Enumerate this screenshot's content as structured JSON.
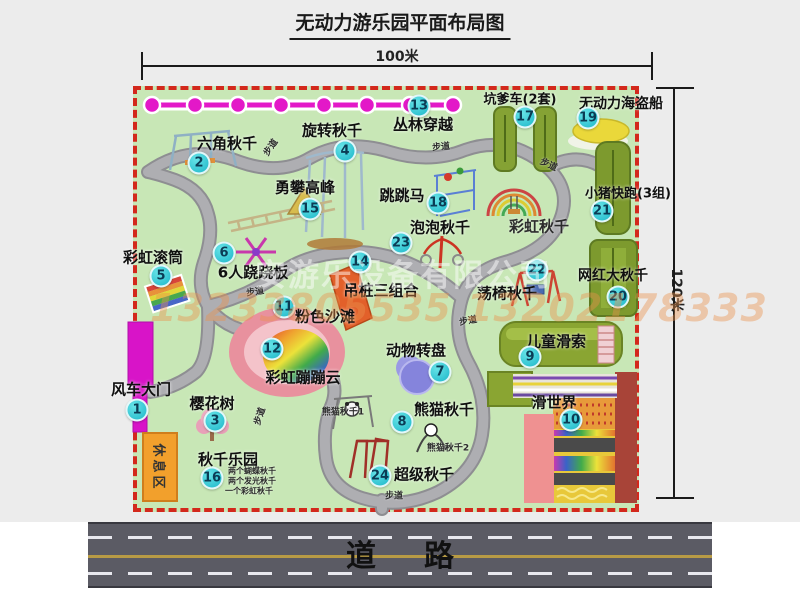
{
  "title": "无动力游乐园平面布局图",
  "dimensions": {
    "top": "100米",
    "right": "120米"
  },
  "road": {
    "label": "道路"
  },
  "watermark": {
    "company": "安游乐设备有限公司",
    "phones": "13233805535 13202178333"
  },
  "rest_area": {
    "label": "休息区"
  },
  "attractions": [
    {
      "num": "1",
      "name": "风车大门",
      "nx": 137,
      "ny": 410,
      "lx": 141,
      "ly": 389,
      "fs": 15
    },
    {
      "num": "2",
      "name": "六角秋千",
      "nx": 199,
      "ny": 163,
      "lx": 227,
      "ly": 143,
      "fs": 15
    },
    {
      "num": "3",
      "name": "樱花树",
      "nx": 215,
      "ny": 421,
      "lx": 212,
      "ly": 403,
      "fs": 15
    },
    {
      "num": "4",
      "name": "旋转秋千",
      "nx": 345,
      "ny": 151,
      "lx": 332,
      "ly": 130,
      "fs": 15
    },
    {
      "num": "5",
      "name": "彩虹滚筒",
      "nx": 161,
      "ny": 276,
      "lx": 153,
      "ly": 257,
      "fs": 15
    },
    {
      "num": "6",
      "name": "6人跷跷板",
      "nx": 224,
      "ny": 253,
      "lx": 253,
      "ly": 272,
      "fs": 15
    },
    {
      "num": "7",
      "name": "动物转盘",
      "nx": 440,
      "ny": 372,
      "lx": 416,
      "ly": 350,
      "fs": 15
    },
    {
      "num": "8",
      "name": "熊猫秋千",
      "nx": 402,
      "ny": 422,
      "lx": 444,
      "ly": 409,
      "fs": 15
    },
    {
      "num": "9",
      "name": "儿童滑索",
      "nx": 530,
      "ny": 357,
      "lx": 556,
      "ly": 341,
      "fs": 15
    },
    {
      "num": "10",
      "name": "滑世界",
      "nx": 571,
      "ny": 420,
      "lx": 554,
      "ly": 402,
      "fs": 15
    },
    {
      "num": "11",
      "name": "粉色沙滩",
      "nx": 284,
      "ny": 307,
      "lx": 325,
      "ly": 316,
      "fs": 15
    },
    {
      "num": "12",
      "name": "彩虹蹦蹦云",
      "nx": 272,
      "ny": 349,
      "lx": 303,
      "ly": 377,
      "fs": 15
    },
    {
      "num": "13",
      "name": "丛林穿越",
      "nx": 419,
      "ny": 106,
      "lx": 423,
      "ly": 124,
      "fs": 15
    },
    {
      "num": "14",
      "name": "吊桩三组合",
      "nx": 360,
      "ny": 262,
      "lx": 381,
      "ly": 290,
      "fs": 15
    },
    {
      "num": "15",
      "name": "勇攀高峰",
      "nx": 310,
      "ny": 209,
      "lx": 305,
      "ly": 187,
      "fs": 15
    },
    {
      "num": "16",
      "name": "秋千乐园",
      "nx": 212,
      "ny": 478,
      "lx": 228,
      "ly": 459,
      "fs": 15
    },
    {
      "num": "17",
      "name": "坑爹车(2套)",
      "nx": 525,
      "ny": 117,
      "lx": 520,
      "ly": 98,
      "fs": 13
    },
    {
      "num": "18",
      "name": "跳跳马",
      "nx": 438,
      "ny": 203,
      "lx": 402,
      "ly": 195,
      "fs": 15
    },
    {
      "num": "19",
      "name": "无动力海盗船",
      "nx": 588,
      "ny": 118,
      "lx": 621,
      "ly": 103,
      "fs": 14
    },
    {
      "num": "20",
      "name": "网红大秋千",
      "nx": 618,
      "ny": 297,
      "lx": 613,
      "ly": 275,
      "fs": 14
    },
    {
      "num": "21",
      "name": "小猪快跑(3组)",
      "nx": 602,
      "ny": 211,
      "lx": 628,
      "ly": 192,
      "fs": 13
    },
    {
      "num": "22",
      "name": "荡椅秋千",
      "nx": 537,
      "ny": 270,
      "lx": 507,
      "ly": 293,
      "fs": 15
    },
    {
      "num": "23",
      "name": "泡泡秋千",
      "nx": 401,
      "ny": 243,
      "lx": 440,
      "ly": 227,
      "fs": 15
    },
    {
      "num": "24",
      "name": "超级秋千",
      "nx": 380,
      "ny": 476,
      "lx": 424,
      "ly": 474,
      "fs": 15
    }
  ],
  "sublabels": [
    {
      "text": "彩虹秋千",
      "x": 539,
      "y": 226,
      "size": 15,
      "rot": 0
    },
    {
      "text": "熊猫秋千1",
      "x": 343,
      "y": 411,
      "size": 9,
      "rot": 0
    },
    {
      "text": "熊猫秋千2",
      "x": 448,
      "y": 447,
      "size": 9,
      "rot": 0
    },
    {
      "text": "两个蝴蝶秋千",
      "x": 252,
      "y": 471,
      "size": 8,
      "rot": 0
    },
    {
      "text": "两个发光秋千",
      "x": 252,
      "y": 481,
      "size": 8,
      "rot": 0
    },
    {
      "text": "一个彩虹秋千",
      "x": 249,
      "y": 491,
      "size": 8,
      "rot": 0
    },
    {
      "text": "步道",
      "x": 270,
      "y": 147,
      "size": 9,
      "rot": -55
    },
    {
      "text": "步道",
      "x": 441,
      "y": 146,
      "size": 9,
      "rot": -5
    },
    {
      "text": "步道",
      "x": 549,
      "y": 164,
      "size": 9,
      "rot": 25
    },
    {
      "text": "步道",
      "x": 255,
      "y": 291,
      "size": 9,
      "rot": -8
    },
    {
      "text": "步道",
      "x": 468,
      "y": 320,
      "size": 9,
      "rot": -10
    },
    {
      "text": "步道",
      "x": 259,
      "y": 416,
      "size": 9,
      "rot": -72
    },
    {
      "text": "步道",
      "x": 394,
      "y": 495,
      "size": 9,
      "rot": 0
    }
  ]
}
